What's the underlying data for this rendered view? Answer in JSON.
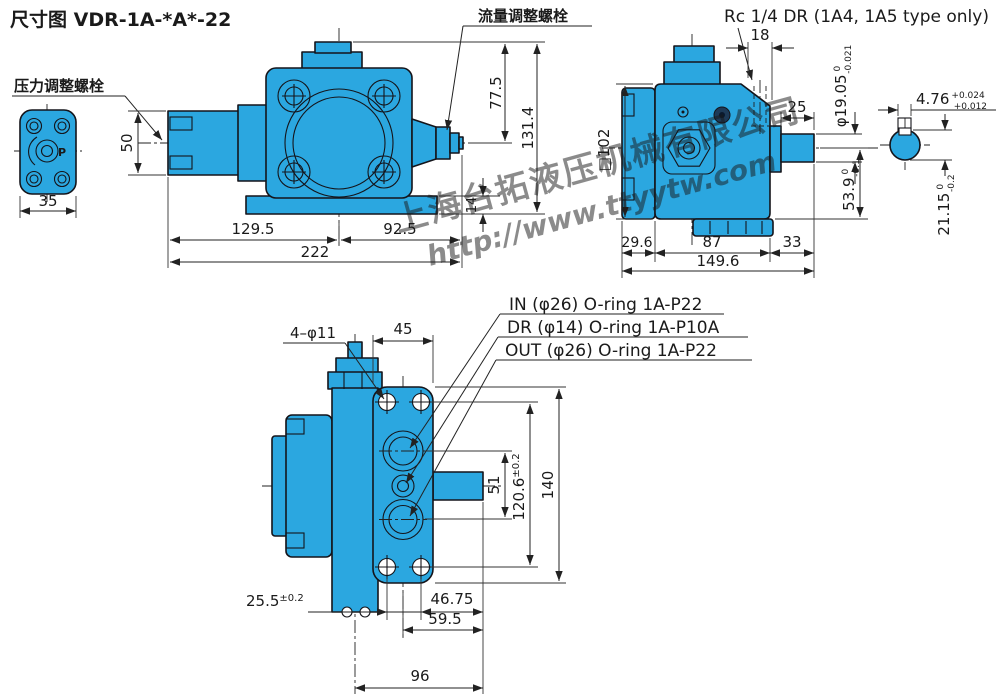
{
  "title": "尺寸图 VDR-1A-*A*-22",
  "labels": {
    "pressure_bolt": "压力调整螺栓",
    "flow_bolt": "流量调整螺栓",
    "rc_port": "Rc 1/4 DR (1A4, 1A5 type only)",
    "port_p": "P",
    "port_in": "IN (φ26) O-ring 1A-P22",
    "port_dr": "DR (φ14) O-ring 1A-P10A",
    "port_out": "OUT (φ26) O-ring 1A-P22"
  },
  "watermark": {
    "company": "上海台拓液压机械有限公司",
    "url": "http://www.ttyytw.com"
  },
  "colors": {
    "body_fill": "#2BA7E0",
    "outline": "#14141a",
    "dim_line": "#222222",
    "watermark": "#3b5bdd"
  },
  "dims": {
    "flange_width": "35",
    "front_end_height": "50",
    "front_left": "129.5",
    "front_right": "92.5",
    "front_total": "222",
    "front_top": "77.5",
    "front_height": "131.4",
    "foot_thickness": "14",
    "side_square": "□102",
    "side_top_offset": "18",
    "shaft_length": "25",
    "shaft_dia": "φ19.05",
    "shaft_dia_tol_top": "0",
    "shaft_dia_tol_bot": "-0.021",
    "key_width": "4.76",
    "key_width_tol_top": "+0.024",
    "key_width_tol_bot": "+0.012",
    "side_bottom": "53.9",
    "side_bottom_tol_top": "0",
    "side_bottom_tol_bot": "-0.1",
    "key_height": "21.15",
    "key_height_tol_top": "0",
    "key_height_tol_bot": "-0.2",
    "side_left": "29.6",
    "side_mid": "87",
    "side_shaft": "33",
    "side_total": "149.6",
    "bolt_holes": "4–φ11",
    "flange_face": "45",
    "port_span": "51",
    "bolt_span": "120.6",
    "bolt_span_tol": "±0.2",
    "flange_height": "140",
    "bolt_pitch": "25.5",
    "bolt_pitch_tol": "±0.2",
    "mount_right": "46.75",
    "mount_port": "59.5",
    "mount_total": "96"
  }
}
